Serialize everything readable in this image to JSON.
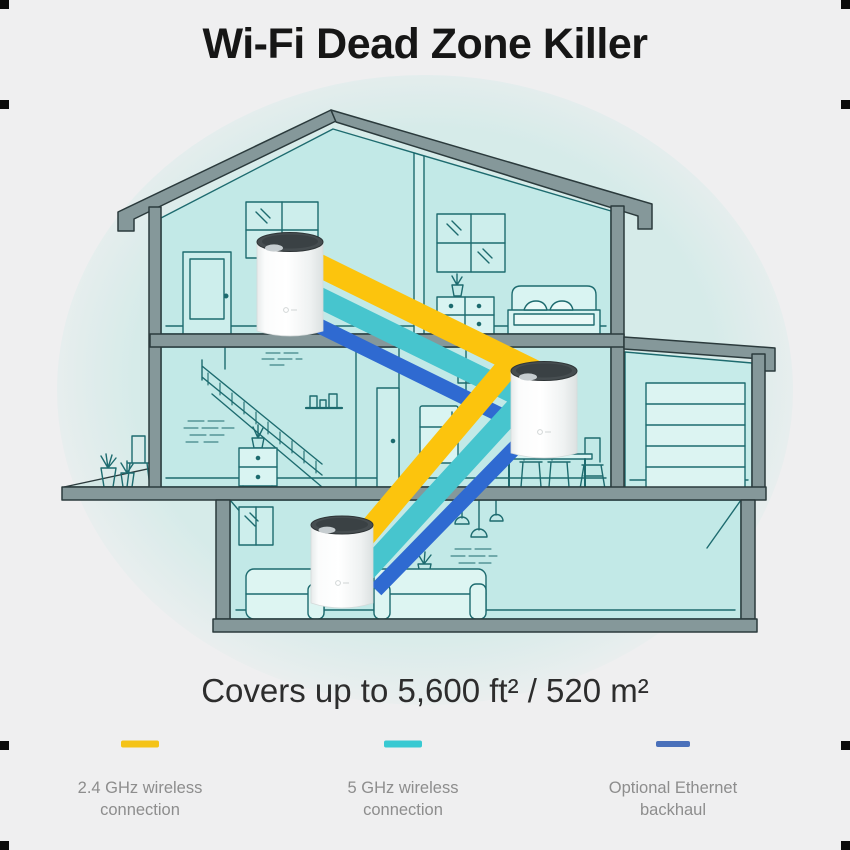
{
  "title": "Wi-Fi Dead Zone Killer",
  "coverage_text": "Covers up to 5,600 ft² / 520 m²",
  "legend": {
    "items": [
      {
        "id": "wifi-2-4ghz",
        "label": "2.4 GHz wireless connection",
        "color": "#F4C318"
      },
      {
        "id": "wifi-5ghz",
        "label": "5 GHz wireless connection",
        "color": "#38C9D2"
      },
      {
        "id": "ethernet",
        "label": "Optional Ethernet backhaul",
        "color": "#4A70BA"
      }
    ]
  },
  "connections": {
    "wifi_24ghz_color": "#FCC40D",
    "wifi_5ghz_color": "#47C5CE",
    "ethernet_color": "#2F6AD1"
  },
  "illustration": {
    "type": "house-cross-section",
    "device_count": 3,
    "devices": [
      {
        "name": "mesh unit — top floor"
      },
      {
        "name": "mesh unit — middle floor"
      },
      {
        "name": "mesh unit — ground floor"
      }
    ]
  }
}
